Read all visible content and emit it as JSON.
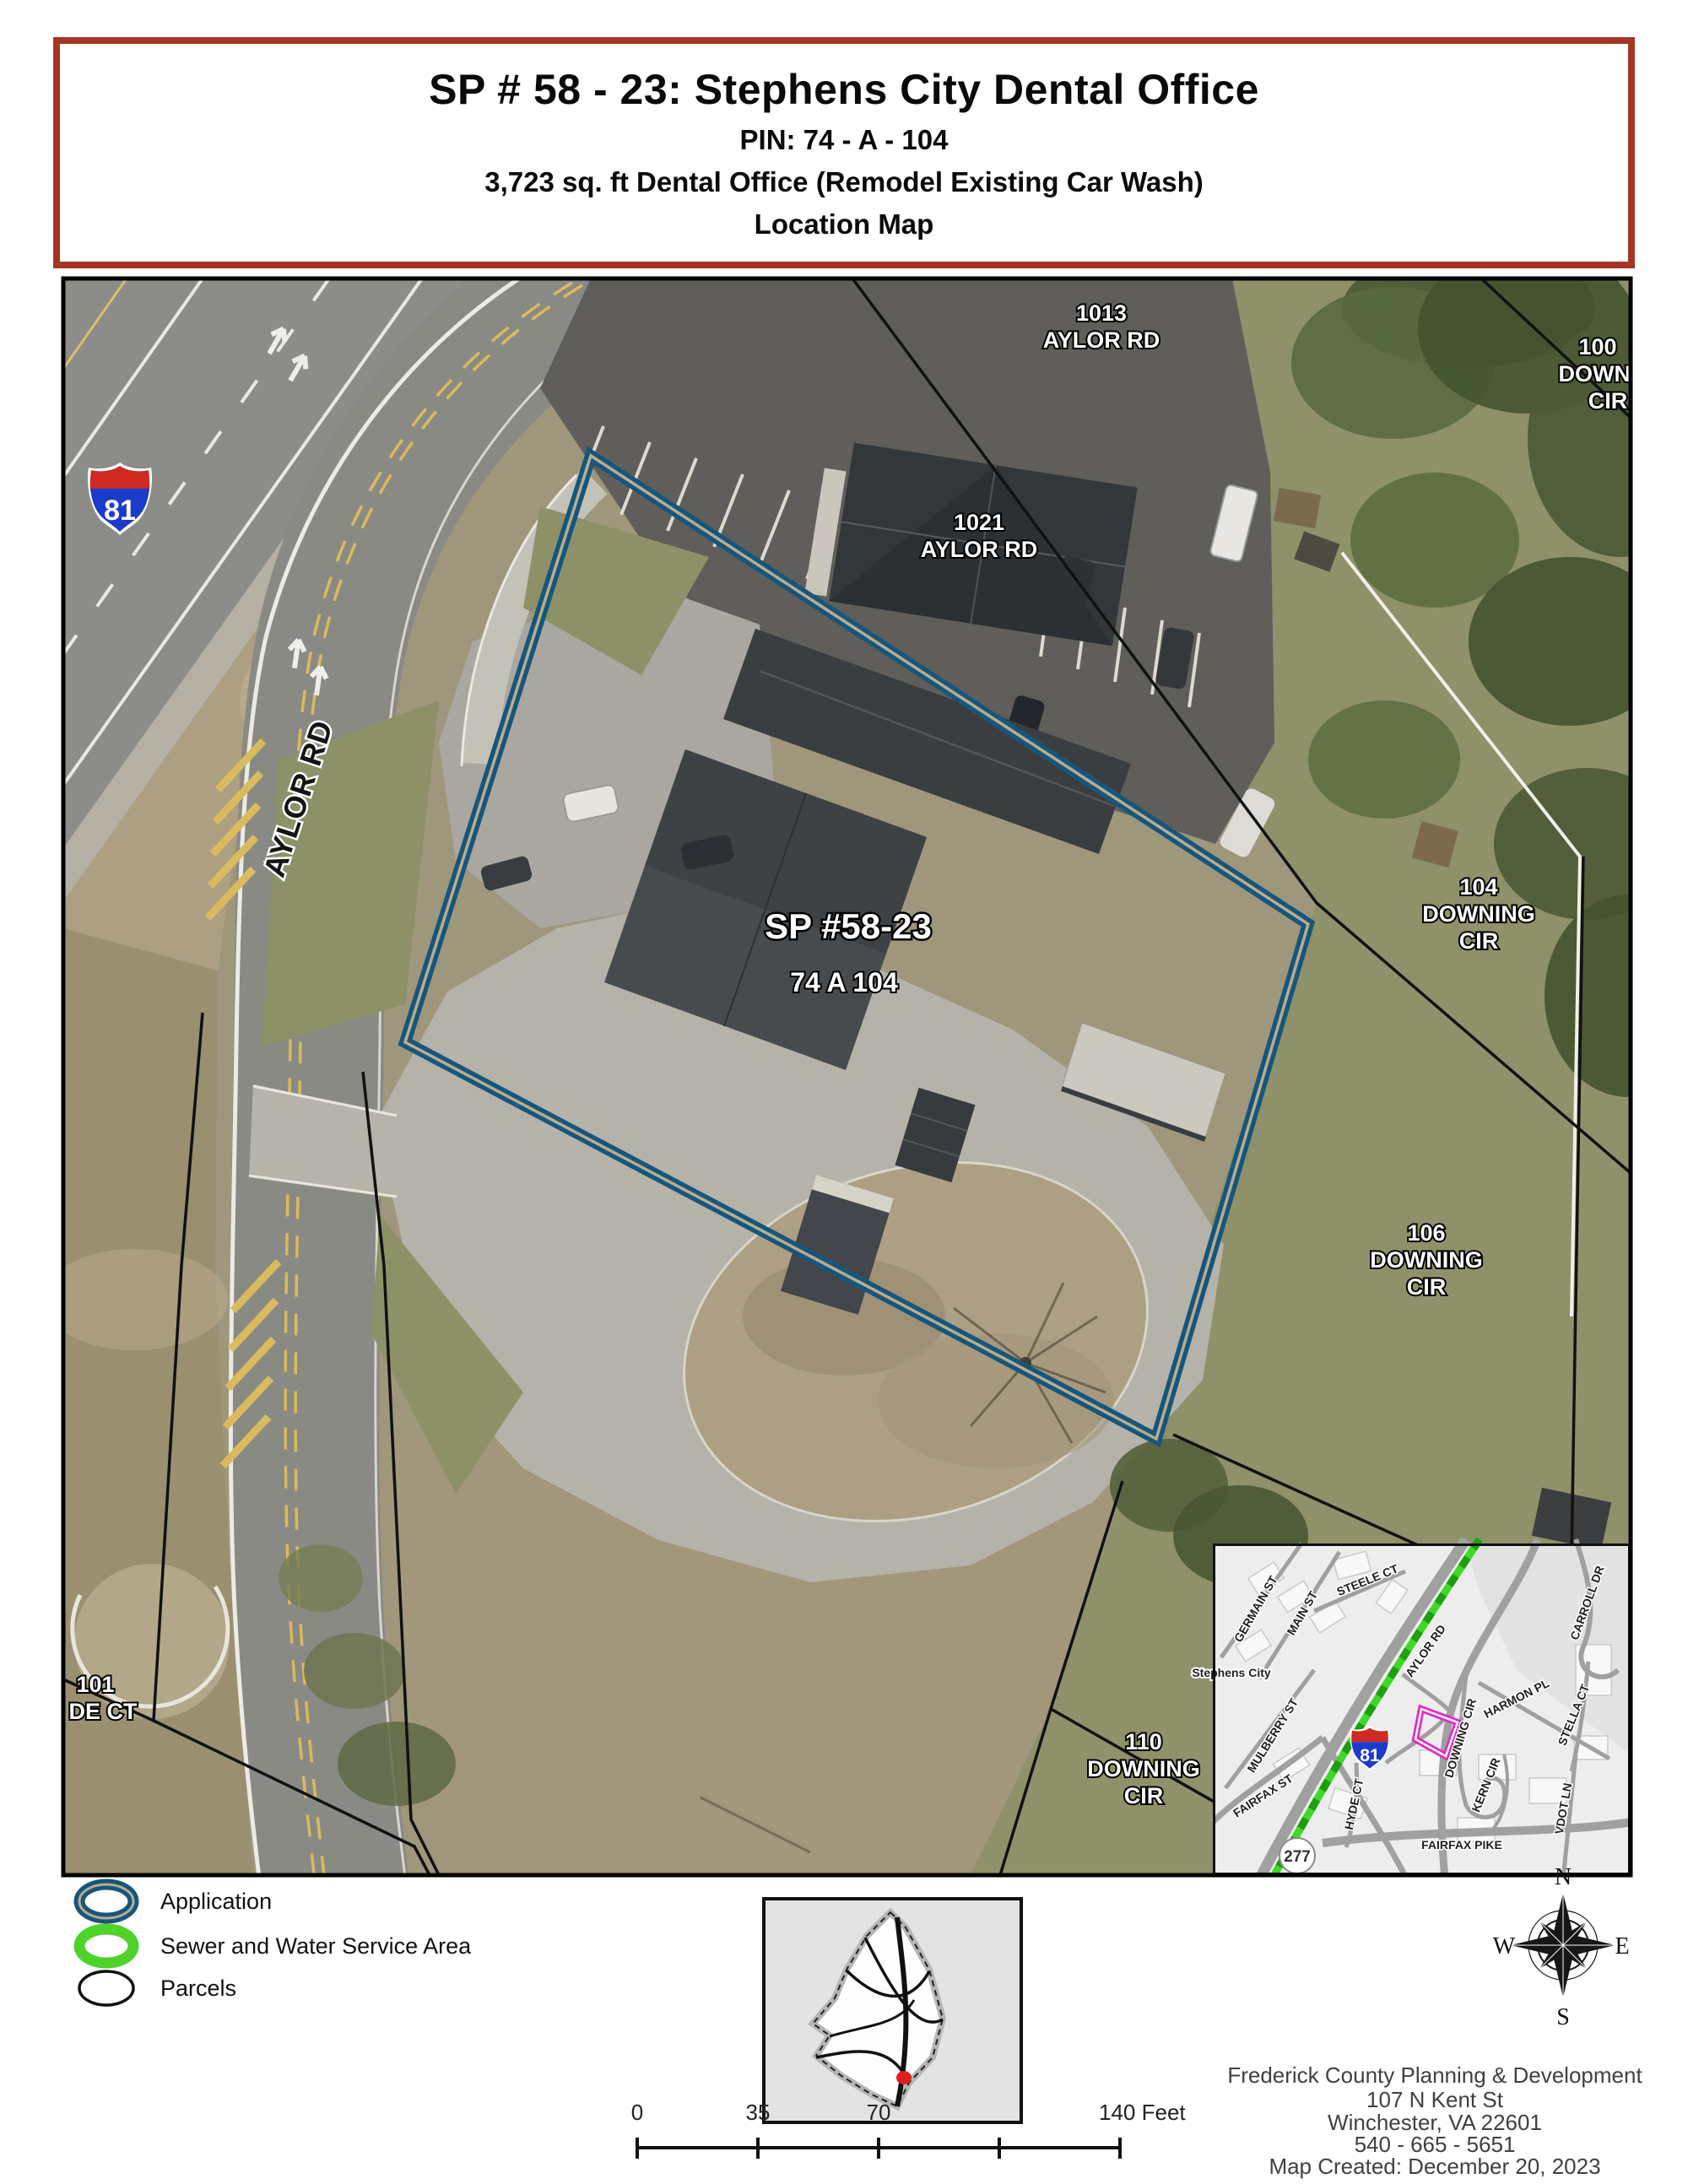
{
  "title": {
    "line1": "SP # 58 - 23: Stephens City Dental Office",
    "line2": "PIN: 74 - A - 104",
    "line3": "3,723 sq. ft Dental Office (Remodel Existing Car Wash)",
    "line4": "Location Map"
  },
  "aerial": {
    "highway_shield": "81",
    "road_label": "AYLOR RD",
    "site": {
      "case_number": "SP #58-23",
      "pin": "74 A 104"
    },
    "parcels": {
      "p1013": [
        "1013",
        "AYLOR RD"
      ],
      "p100": [
        "100",
        "DOWNI",
        "CIR"
      ],
      "p1021": [
        "1021",
        "AYLOR RD"
      ],
      "p104": [
        "104",
        "DOWNING",
        "CIR"
      ],
      "p106": [
        "106",
        "DOWNING",
        "CIR"
      ],
      "p110": [
        "110",
        "DOWNING",
        "CIR"
      ],
      "p101": [
        "101",
        "DE CT"
      ]
    }
  },
  "inset": {
    "city": "Stephens City",
    "interstate": "81",
    "route": "277",
    "streets": {
      "germain": "GERMAIN ST",
      "main": "MAIN ST",
      "steele": "STEELE CT",
      "carroll": "CARROLL DR",
      "aylor": "AYLOR RD",
      "harmon": "HARMON PL",
      "downing": "DOWNING CIR",
      "mulberry": "MULBERRY ST",
      "fairfax_st": "FAIRFAX ST",
      "hyde": "HYDE CT",
      "kern": "KERN CIR",
      "stella": "STELLA CT",
      "vdot": "VDOT LN",
      "fairfax_pike": "FAIRFAX PIKE"
    }
  },
  "legend": {
    "items": [
      {
        "label": "Application",
        "symbol": "blue-double-ellipse"
      },
      {
        "label": "Sewer and Water Service Area",
        "symbol": "green-ellipse"
      },
      {
        "label": "Parcels",
        "symbol": "black-ellipse"
      }
    ]
  },
  "compass": {
    "n": "N",
    "e": "E",
    "s": "S",
    "w": "W"
  },
  "scalebar": {
    "labels": [
      "0",
      "35",
      "70",
      "140 Feet"
    ]
  },
  "credits": {
    "lines": [
      "Frederick County Planning & Development",
      "107 N Kent St",
      "Winchester, VA 22601",
      "540 - 665 - 5651",
      "Map Created: December 20, 2023"
    ]
  },
  "colors": {
    "title_border": "#a53525",
    "application_blue": "#17567c",
    "application_inner_tan": "#b9ac8e",
    "sewer_green": "#4fd32a",
    "parcel_black": "#111111",
    "site_magenta": "#df2bc7",
    "interstate_red": "#cf2a24",
    "interstate_blue": "#1c3bcb",
    "locator_dot_red": "#e21d1d"
  }
}
